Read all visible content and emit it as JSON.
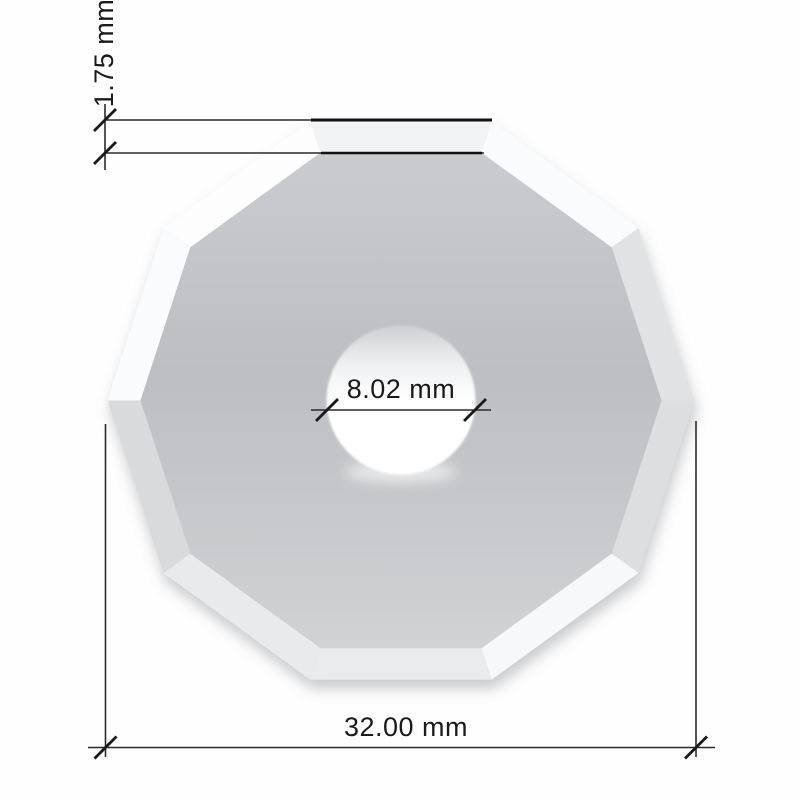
{
  "drawing": {
    "title": "decagonal blade dimension drawing",
    "blade_shape": "decagon",
    "sides": 10,
    "labels": {
      "bevel_width": "1.75 mm",
      "hole_diameter": "8.02 mm",
      "outer_diameter": "32.00 mm"
    },
    "values": {
      "bevel_width_mm": 1.75,
      "hole_diameter_mm": 8.02,
      "outer_diameter_mm": 32.0
    },
    "colors": {
      "background": "#fefefe",
      "dim_line": "#2a2a2a",
      "edge_line": "#121212",
      "tick": "#1a1a1a",
      "text": "#1a1a1a",
      "shadow": "#70757c",
      "face_gradient": [
        "#c9cbce",
        "#bcbec1",
        "#d0d2d4"
      ],
      "hole_gradient": [
        "#cdcfd1",
        "#eff0f1",
        "#ffffff"
      ],
      "facet_colors": [
        "#fafbfc",
        "#e0e2e4",
        "#dcdee0",
        "#f6f8fa",
        "#e9ebed",
        "#e8eaec",
        "#d8dadc",
        "#fafbfc",
        "#fdfdfe",
        "#f2f3f5"
      ]
    },
    "geometry": {
      "canvas": {
        "w": 800,
        "h": 800
      },
      "center": {
        "x": 401,
        "y": 400.5
      },
      "outer_radius": 293.5,
      "inner_radius": 260.5,
      "hole_radius": 74.5,
      "tick_half": 11,
      "dim_bevel": {
        "line1": [
          105,
          120,
          492
        ],
        "line1_bold": [
          311,
          120,
          492
        ],
        "line2": [
          105,
          153,
          484
        ],
        "line2_bold": [
          321,
          153,
          482
        ],
        "connector": [
          105,
          104,
          170
        ],
        "ticks": [
          [
            105,
            120
          ],
          [
            105,
            153
          ]
        ],
        "label": [
          104,
          53
        ]
      },
      "dim_hole": {
        "line": [
          311,
          410,
          491
        ],
        "ticks": [
          [
            327,
            410
          ],
          [
            475,
            410
          ]
        ],
        "label": [
          401,
          389
        ]
      },
      "dim_outer": {
        "ext_left": [
          105.5,
          424,
          757
        ],
        "ext_right": [
          696,
          421,
          757
        ],
        "line": [
          88,
          747.5,
          715
        ],
        "ticks": [
          [
            105.5,
            747.5
          ],
          [
            696,
            747.5
          ]
        ],
        "label": [
          406,
          727
        ]
      }
    }
  }
}
